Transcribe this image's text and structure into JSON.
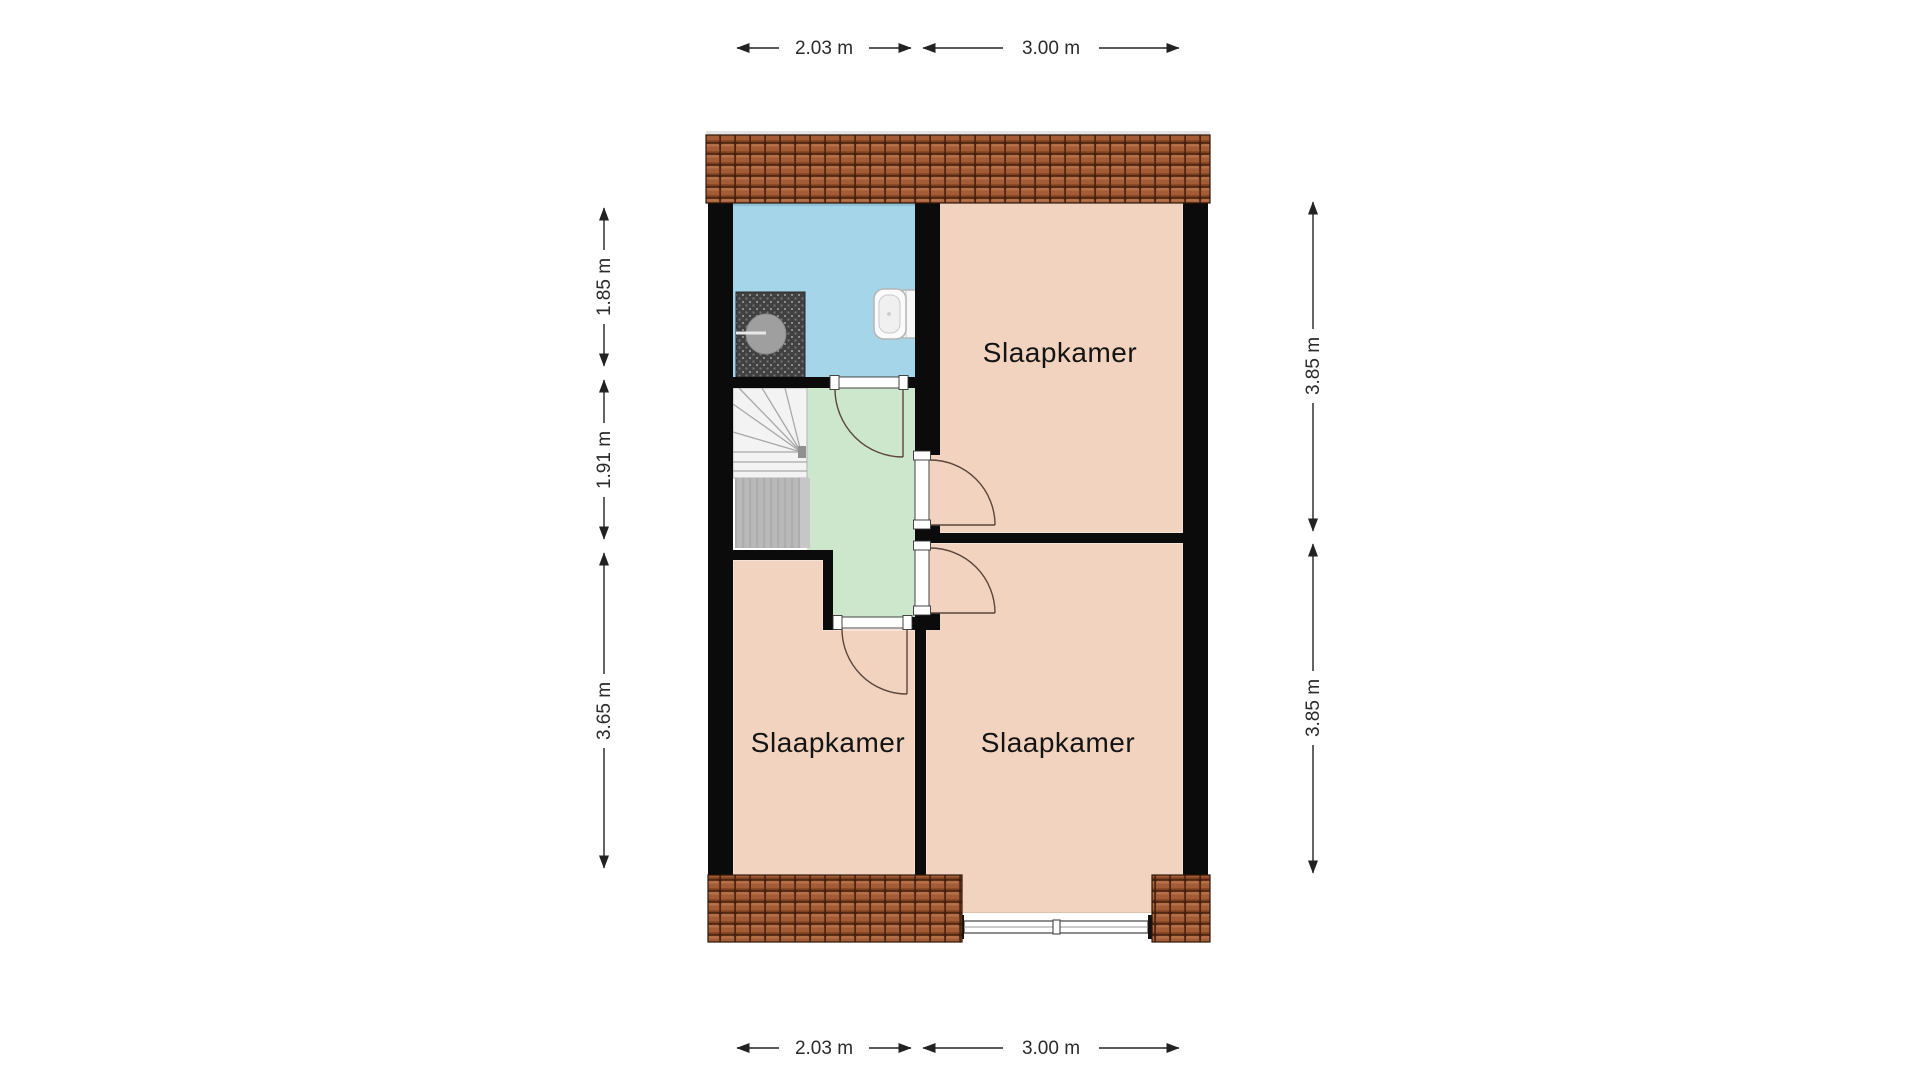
{
  "rooms": {
    "bedroom_top_right": "Slaapkamer",
    "bedroom_bottom_left": "Slaapkamer",
    "bedroom_bottom_right": "Slaapkamer"
  },
  "dims": {
    "top_1": "2.03 m",
    "top_2": "3.00 m",
    "bottom_1": "2.03 m",
    "bottom_2": "3.00 m",
    "left_1": "1.85 m",
    "left_2": "1.91 m",
    "left_3": "3.65 m",
    "right_1": "3.85 m",
    "right_2": "3.85 m"
  },
  "colors": {
    "bedroom_fill": "#f2d3bf",
    "bathroom_fill": "#a5d5e9",
    "hall_fill": "#cde7cc",
    "wall": "#0b0b0b",
    "roof_tile": "#a45c36",
    "dimension_text": "#2b2b2b",
    "room_label_text": "#141414"
  },
  "fixtures": [
    "staircase",
    "shower",
    "toilet",
    "window",
    "door-swing"
  ]
}
